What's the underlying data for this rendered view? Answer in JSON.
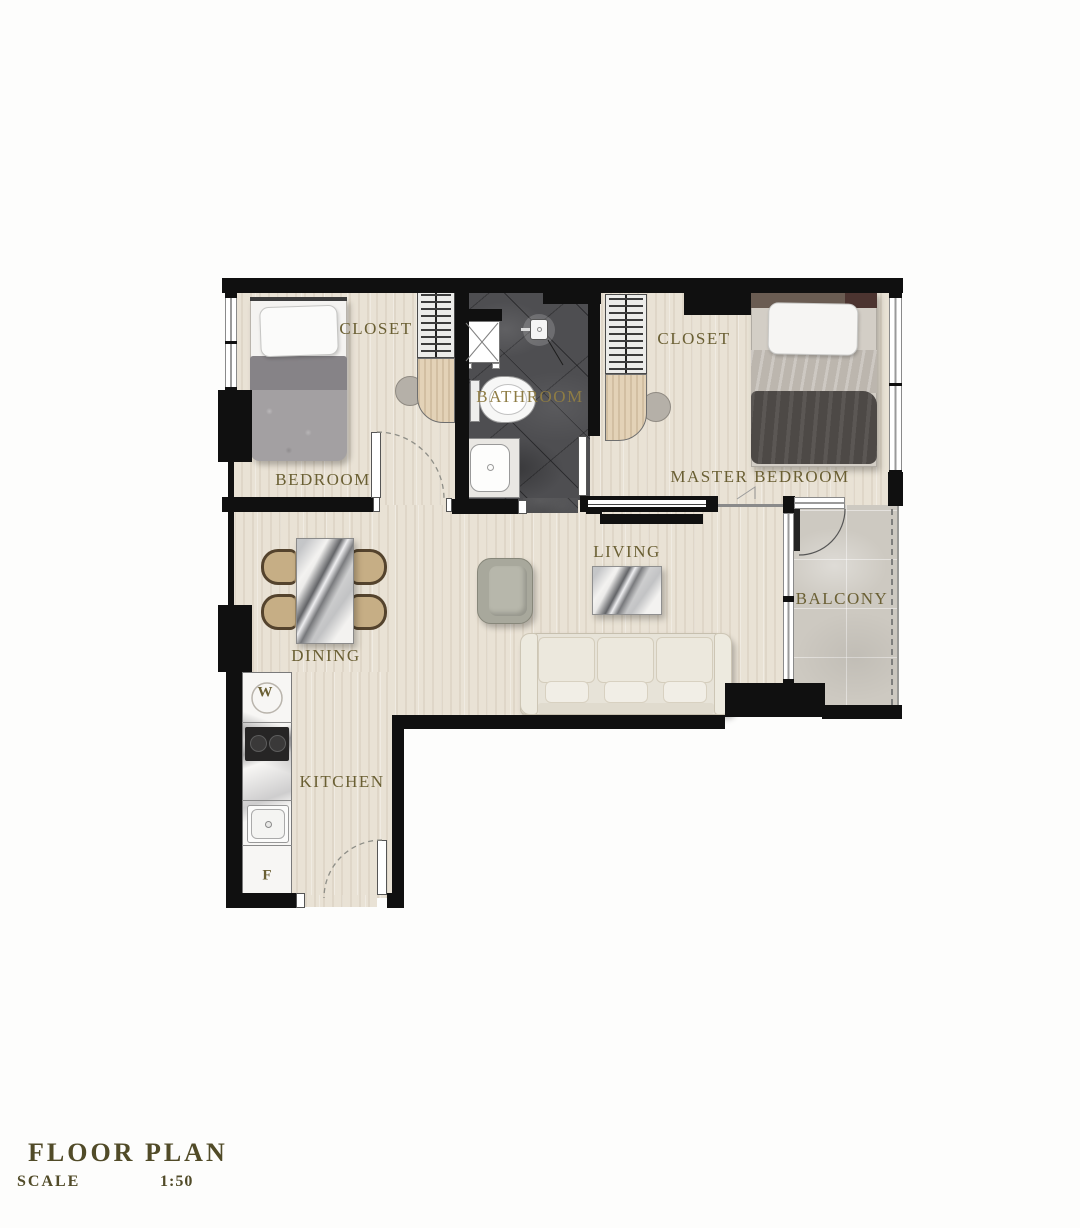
{
  "title": {
    "main": "FLOOR PLAN",
    "scale_label": "SCALE",
    "scale_value": "1:50"
  },
  "rooms": [
    {
      "id": "bedroom",
      "label": "BEDROOM"
    },
    {
      "id": "bedroom-closet",
      "label": "CLOSET"
    },
    {
      "id": "bathroom",
      "label": "BATHROOM"
    },
    {
      "id": "master-closet",
      "label": "CLOSET"
    },
    {
      "id": "master-bedroom",
      "label": "MASTER BEDROOM"
    },
    {
      "id": "living",
      "label": "LIVING"
    },
    {
      "id": "dining",
      "label": "DINING"
    },
    {
      "id": "balcony",
      "label": "BALCONY"
    },
    {
      "id": "kitchen",
      "label": "KITCHEN"
    }
  ],
  "appliances": [
    {
      "id": "washer",
      "label": "W"
    },
    {
      "id": "refrigerator",
      "label": "F"
    }
  ],
  "colors": {
    "wall": "#101010",
    "room_label": "#6a5f33",
    "title_text": "#514b28",
    "floor_wood": "#e9e2d5",
    "floor_bathroom": "#4e4e51",
    "floor_balcony": "#cdc9c1",
    "closet_wood": "#e3d2b7"
  }
}
